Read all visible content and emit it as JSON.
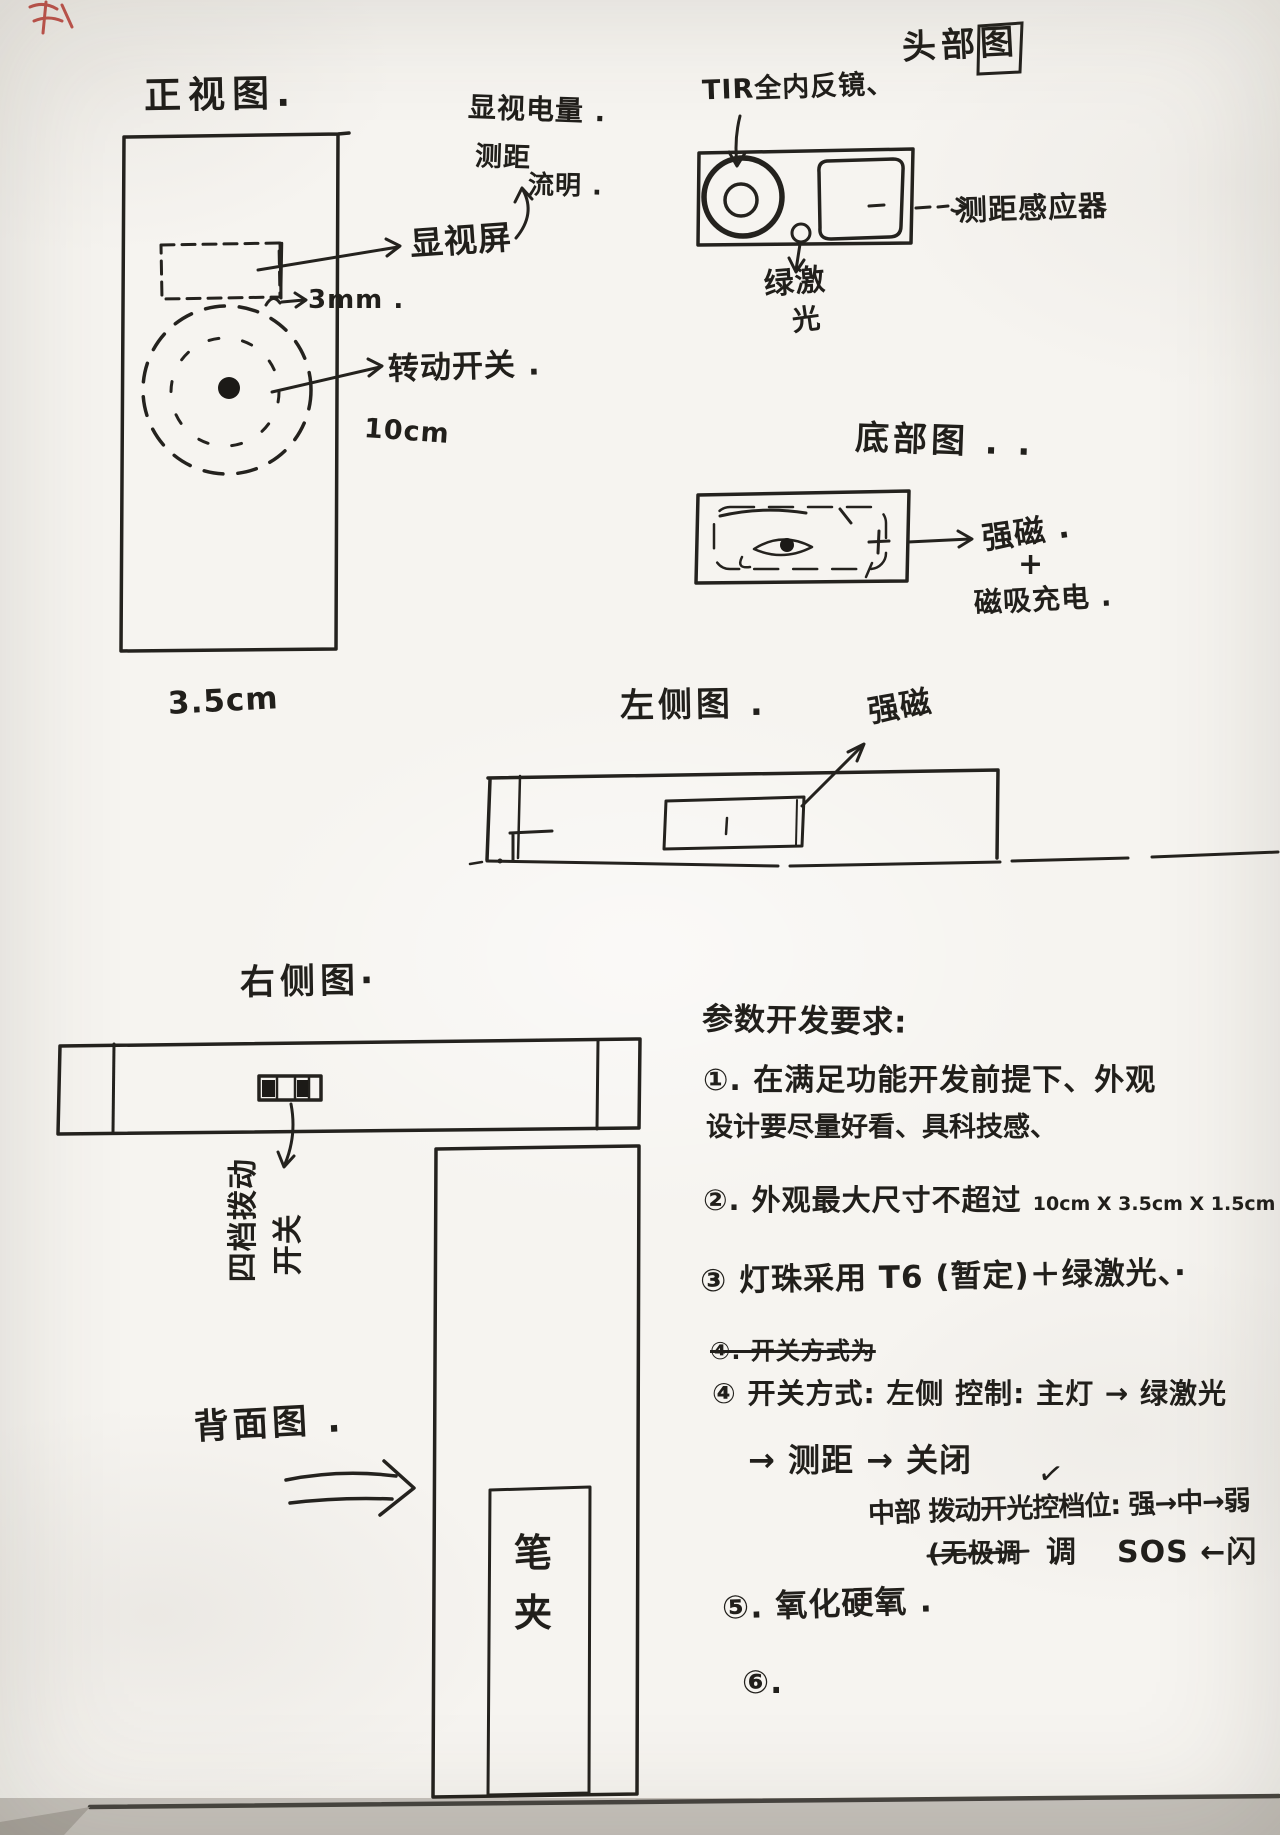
{
  "front_view": {
    "title": "正视图.",
    "note_line1": "显视电量 .",
    "note_line2": "测距",
    "note_line3": "流明 .",
    "screen_label": "显视屏",
    "gap_label": "3mm .",
    "dial_label": "转动开关 .",
    "length_label": "10cm",
    "width_label": "3.5cm"
  },
  "head_view": {
    "title": "头部图",
    "lens_label": "TIR全内反镜、",
    "sensor_label": "测距感应器",
    "laser_line1": "绿激",
    "laser_line2": "光"
  },
  "bottom_view": {
    "title": "底部图 . .",
    "magnet_label": "强磁 .",
    "plus_sign": "+",
    "charging_label": "磁吸充电 ."
  },
  "left_view": {
    "title": "左侧图 .",
    "magnet_label": "强磁"
  },
  "right_view": {
    "title": "右侧图·",
    "switch_label_part1": "四档拨动",
    "switch_label_part2": "开关"
  },
  "back_view": {
    "title": "背面图 .",
    "clip_char1": "笔",
    "clip_char2": "夹"
  },
  "requirements": {
    "heading": "参数开发要求:",
    "item1_line1": "①. 在满足功能开发前提下、外观",
    "item1_line2": "设计要尽量好看、具科技感、",
    "item2_cjk": "②. 外观最大尺寸不超过",
    "item2_dims": "10cm X 3.5cm X 1.5cm .",
    "item3": "③ 灯珠采用 T6 (暂定)＋绿激光、·",
    "item4_struck": "④. 开关方式为",
    "item4_main": "④ 开关方式: 左侧 控制: 主灯 → 绿激光",
    "item4_line2": "→ 测距 → 关闭",
    "check_mark": "✓",
    "item4_line3": "中部 拨动开光控档位: 强→中→弱",
    "item4_line4_struck": "(无极调",
    "item4_line4_mid": "调",
    "item4_line4_end": "SOS ←闪",
    "item5": "⑤. 氧化硬氧 .",
    "item6": "⑥."
  }
}
